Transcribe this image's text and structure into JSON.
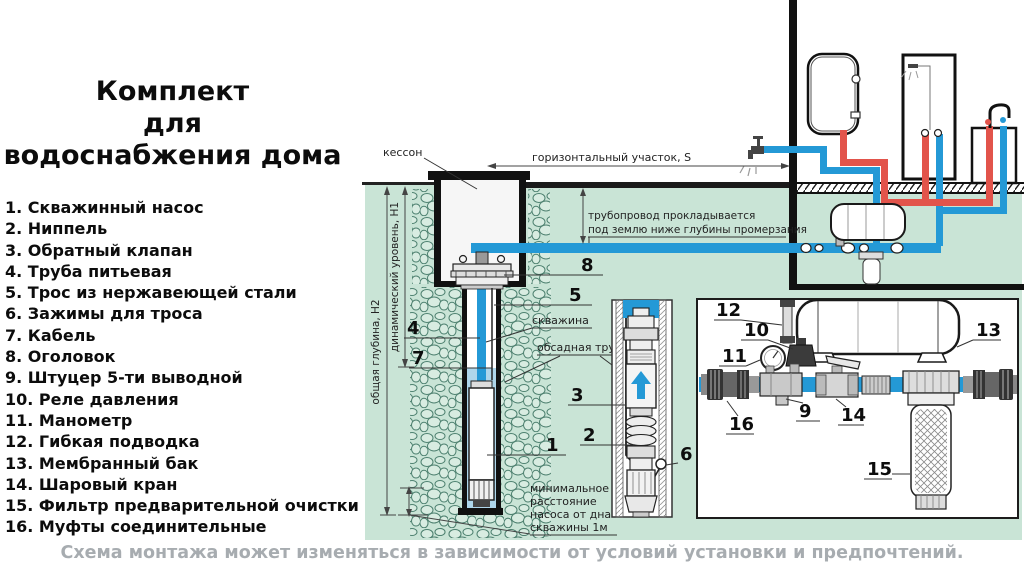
{
  "title": {
    "lines": [
      "Комплект",
      "для",
      "водоснабжения дома"
    ]
  },
  "parts_list": [
    "1. Скважинный насос",
    "2. Ниппель",
    "3. Обратный клапан",
    "4. Труба питьевая",
    "5. Трос из нержавеющей стали",
    "6. Зажимы для троса",
    "7. Кабель",
    "8. Оголовок",
    "9. Штуцер 5-ти выводной",
    "10. Реле давления",
    "11. Манометр",
    "12. Гибкая подводка",
    "13. Мембранный бак",
    "14. Шаровый кран",
    "15. Фильтр предварительной очистки",
    "16. Муфты соединительные"
  ],
  "diagram": {
    "labels": {
      "kesson": "кессон",
      "horizontal_section": "горизонтальный участок, S",
      "pipeline_note_1": "трубопровод прокладывается",
      "pipeline_note_2": "под землю ниже глубины промерзания",
      "well": "скважина",
      "casing": "обсадная труба",
      "total_depth": "общая глубина, Н2",
      "dynamic_level": "динамический уровень, Н1",
      "min_distance_1": "минимальное",
      "min_distance_2": "расстояние",
      "min_distance_3": "насоса от дна",
      "min_distance_4": "скважины 1м"
    },
    "callouts": {
      "c1": "1",
      "c2": "2",
      "c3": "3",
      "c4": "4",
      "c5": "5",
      "c6": "6",
      "c7": "7",
      "c8": "8",
      "c9": "9",
      "c10": "10",
      "c11": "11",
      "c12": "12",
      "c13": "13",
      "c14": "14",
      "c15": "15",
      "c16": "16"
    },
    "colors": {
      "ground": "#c9e4d6",
      "cold_pipe": "#2499d6",
      "hot_pipe": "#e2544b",
      "well_water": "#aed6eb",
      "line": "#1a1a1a"
    }
  },
  "footer": {
    "caption": "Схема монтажа может изменяться в зависимости от условий установки и предпочтений."
  }
}
